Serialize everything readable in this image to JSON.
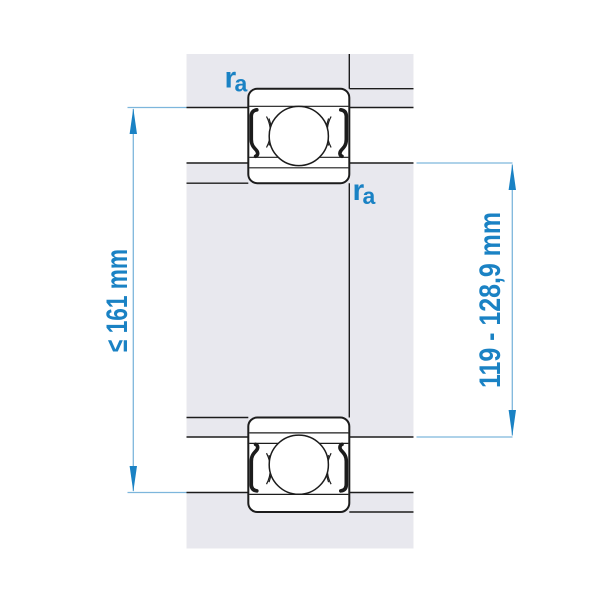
{
  "figure": {
    "type": "bearing-mounting-dimension-drawing",
    "left_dimension": {
      "label": "≤ 161 mm"
    },
    "right_dimension": {
      "label": "119 - 128,9 mm"
    },
    "fillet_label_top": {
      "base": "r",
      "subscript": "a"
    },
    "fillet_label_bottom": {
      "base": "r",
      "subscript": "a"
    },
    "colors": {
      "accent_blue": "#1a82c4",
      "light_blue_line": "#7db6dc",
      "section_gray": "#e8e8ee",
      "outline_black": "#1c1c1c",
      "background": "#ffffff"
    }
  }
}
